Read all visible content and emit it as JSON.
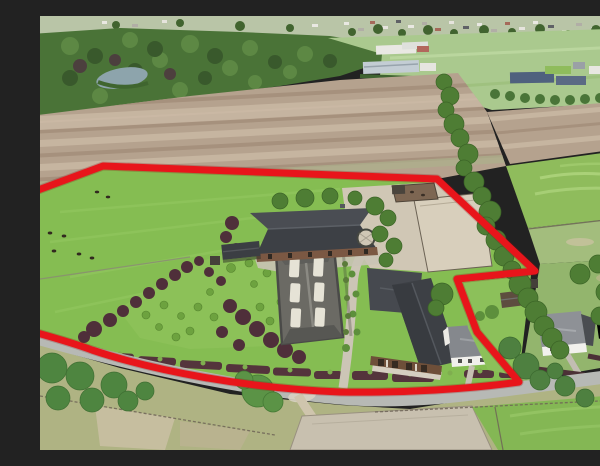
{
  "scene": {
    "type": "aerial-photograph",
    "description": "Drone aerial view of a rural equestrian property outlined with a red plot boundary, surrounded by plowed fields, pastures, a tree-lined lane and neighboring cottages",
    "features": [
      "village horizon band",
      "forest belt with small lake",
      "white industrial sheds",
      "farm with solar-panel roofs",
      "large plowed fields",
      "green crop fields",
      "tree-lined lane",
      "cattle pasture",
      "landscaped garden with copper-beech trees",
      "stable block",
      "riding hall with roof skylights",
      "main barn complex",
      "white bungalow",
      "sand paddock and horse walker",
      "neighboring white cottages (excluded notch)",
      "access road with paddocks and sand arena"
    ]
  },
  "boundary": {
    "color": "#e8151b",
    "shadow_color": "#8e0d10",
    "stroke_width": 7,
    "path": "M -10 177 L 63 150 L 397 163 L 495 255 L 417 263 L 437 316 L 479 366 C 430 373 365 377 300 376 C 205 372 115 355 52 334 C 30 326 8 320 -10 315"
  },
  "road": {
    "path": "M -10 320 C 80 346 190 372 300 382 C 370 388 432 378 480 372 L 612 355"
  },
  "palette": {
    "sky_band": "#b9c5a7",
    "forest_green": "#4a7337",
    "lake_blue": "#8da4ac",
    "field_tan": "#b5a28e",
    "field_light": "#c6b5a0",
    "field_shadow": "#a6917d",
    "crop_green": "#8fbc5c",
    "pasture_green": "#85bd52",
    "lawn_green": "#8cc158",
    "yard_tan": "#d0c7b5",
    "sand": "#c8c0af",
    "road_gray": "#b7b9b5",
    "dry_grass": "#afb383",
    "roof_dark": "#3d4045",
    "roof_gray": "#6b6a64",
    "roof_medium": "#85888d",
    "wall_white": "#f1f0ec",
    "brick": "#7b5843",
    "hedge_maroon": "#54343c",
    "tree_green": "#4e7d34",
    "tree_dark": "#3c6527",
    "tree_maroon": "#4f2f3a"
  }
}
